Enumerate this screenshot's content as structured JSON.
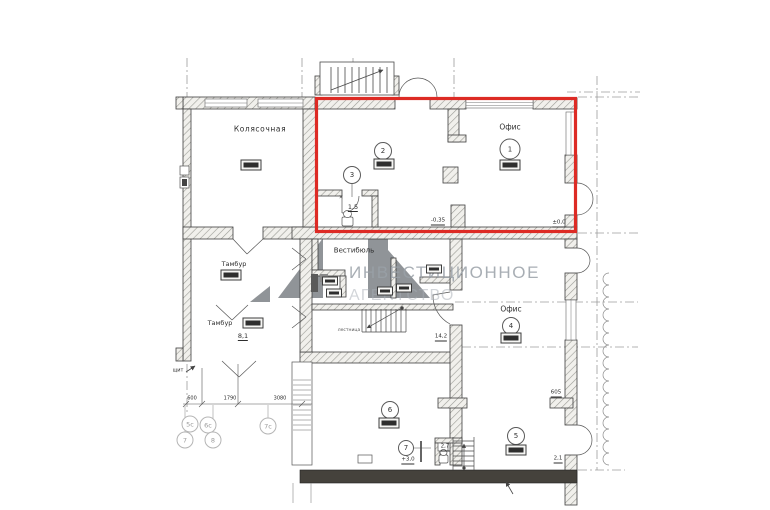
{
  "watermark": {
    "line1": "ИНВЕСТИЦИОННОЕ",
    "line2": "АГЕНТСТВО"
  },
  "rooms": {
    "stroller_label": "Колясочная",
    "vestibule_label": "Вестибюль",
    "tambour1_label": "Тамбур",
    "tambour2_label": "Тамбур",
    "office1_label": "Офис",
    "office4_label": "Офис",
    "stair_label": "лестница"
  },
  "room_numbers": {
    "n1": "1",
    "n2": "2",
    "n3": "3",
    "n4": "4",
    "n5": "5",
    "n6": "6",
    "n7": "7"
  },
  "areas": {
    "wc3": "1,5",
    "tambour2": "8,1",
    "stair_hall": "14,2",
    "wc7": "2,7"
  },
  "marks": {
    "level_zero": "±0,0",
    "level_entry": "-0,35",
    "dim605": "605",
    "mark21": "2,1",
    "mark30": "+3,0",
    "panel": "щит",
    "x_mark": "×"
  },
  "dimensions": {
    "d600": "600",
    "d1790": "1790",
    "d3080": "3080"
  },
  "axes": {
    "a5s": "5с",
    "a6s": "6с",
    "a7": "7",
    "a8": "8",
    "a7s": "7с"
  }
}
